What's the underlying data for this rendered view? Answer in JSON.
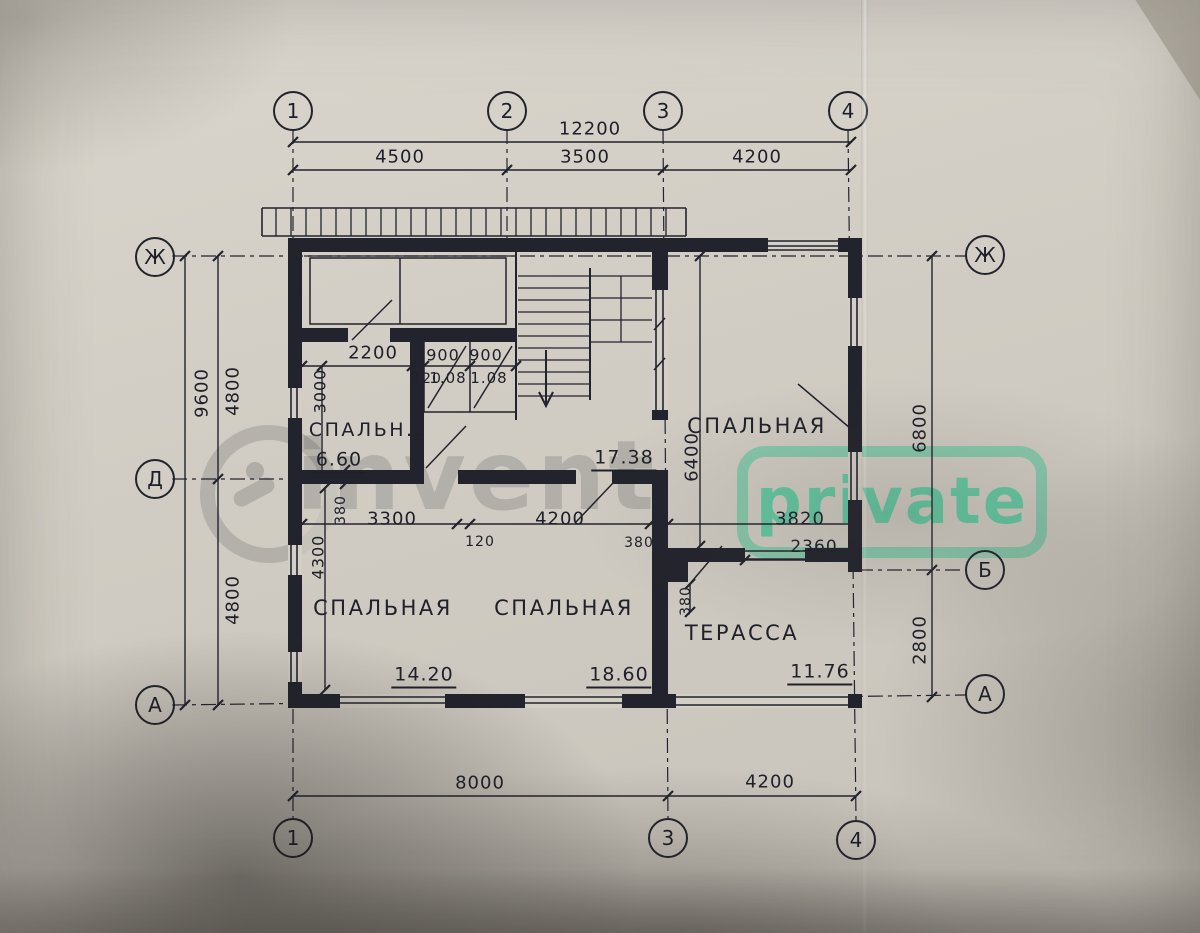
{
  "watermark": {
    "brand": "invent",
    "badge": "private",
    "accent_green": "#3ac694"
  },
  "axis_circles": {
    "top": [
      "1",
      "2",
      "3",
      "4"
    ],
    "bottom": [
      "1",
      "3",
      "4"
    ],
    "left": [
      "Ж",
      "Д",
      "А"
    ],
    "right": [
      "Ж",
      "Б",
      "А"
    ]
  },
  "outer_dims": {
    "top_total": "12200",
    "top_1_2": "4500",
    "top_2_3": "3500",
    "top_3_4": "4200",
    "left_total": "9600",
    "left_upper": "4800",
    "left_lower": "4800",
    "right_upper": "6800",
    "right_lower": "2800",
    "bottom_1_3": "8000",
    "bottom_3_4": "4200"
  },
  "inner_dims": {
    "hall_width": "2200",
    "closet_left": "900",
    "closet_right": "900",
    "wall_thin": "120",
    "closet_left_area": "1.08",
    "closet_right_area": "1.08",
    "bed1_height": "3000",
    "wall_mid": "380",
    "bed3_width": "3300",
    "wall_120": "120",
    "bed4_width": "4200",
    "wall_380": "380",
    "terrace_width": "3820",
    "bed3_height": "4300",
    "bed2_height": "6400",
    "terrace_door": "2360",
    "terrace_wall": "380"
  },
  "rooms": {
    "bed1": {
      "name": "СПАЛЬН..",
      "area": "6.60"
    },
    "bed2": {
      "name": "СПАЛЬНАЯ",
      "area": "17.38"
    },
    "bed3": {
      "name": "СПАЛЬНАЯ",
      "area": "14.20"
    },
    "bed4": {
      "name": "СПАЛЬНАЯ",
      "area": "18.60"
    },
    "terrace": {
      "name": "ТЕРАССА",
      "area": "11.76"
    }
  }
}
